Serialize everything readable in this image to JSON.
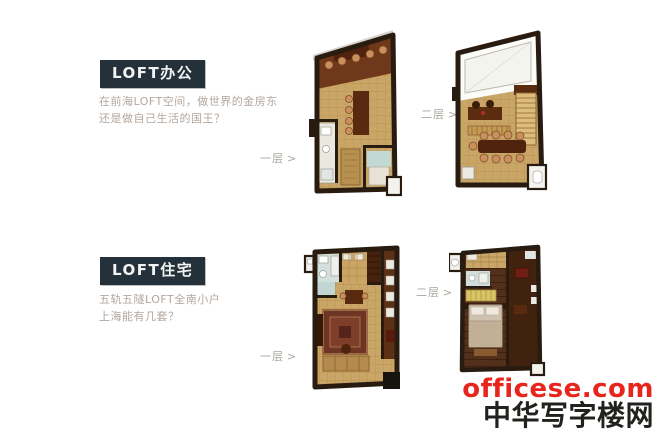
{
  "colors": {
    "page_bg": "#ffffff",
    "badge_bg": "#25313a",
    "badge_text": "#f2f4f3",
    "tagline_text": "#b4a69d",
    "caption_text": "#a9a59f",
    "wall_dark": "#281b10",
    "floor_tan": "#c9a567",
    "chair_copper": "#c98f5f",
    "watermark_red": "#e8251c",
    "watermark_dark": "#23211d"
  },
  "sections": [
    {
      "badge": "LOFT办公",
      "tagline_line1": "在前海LOFT空间，做世界的金房东",
      "tagline_line2": "还是做自己生活的国王？",
      "floor1_label": "一层",
      "floor2_label": "二层",
      "arrow": ">"
    },
    {
      "badge": "LOFT住宅",
      "tagline_line1": "五轨五隧LOFT全南小户",
      "tagline_line2": "上海能有几套？",
      "floor1_label": "一层",
      "floor2_label": "二层",
      "arrow": ">"
    }
  ],
  "watermark": {
    "site": "officese.com",
    "brand": "中华写字楼网"
  }
}
